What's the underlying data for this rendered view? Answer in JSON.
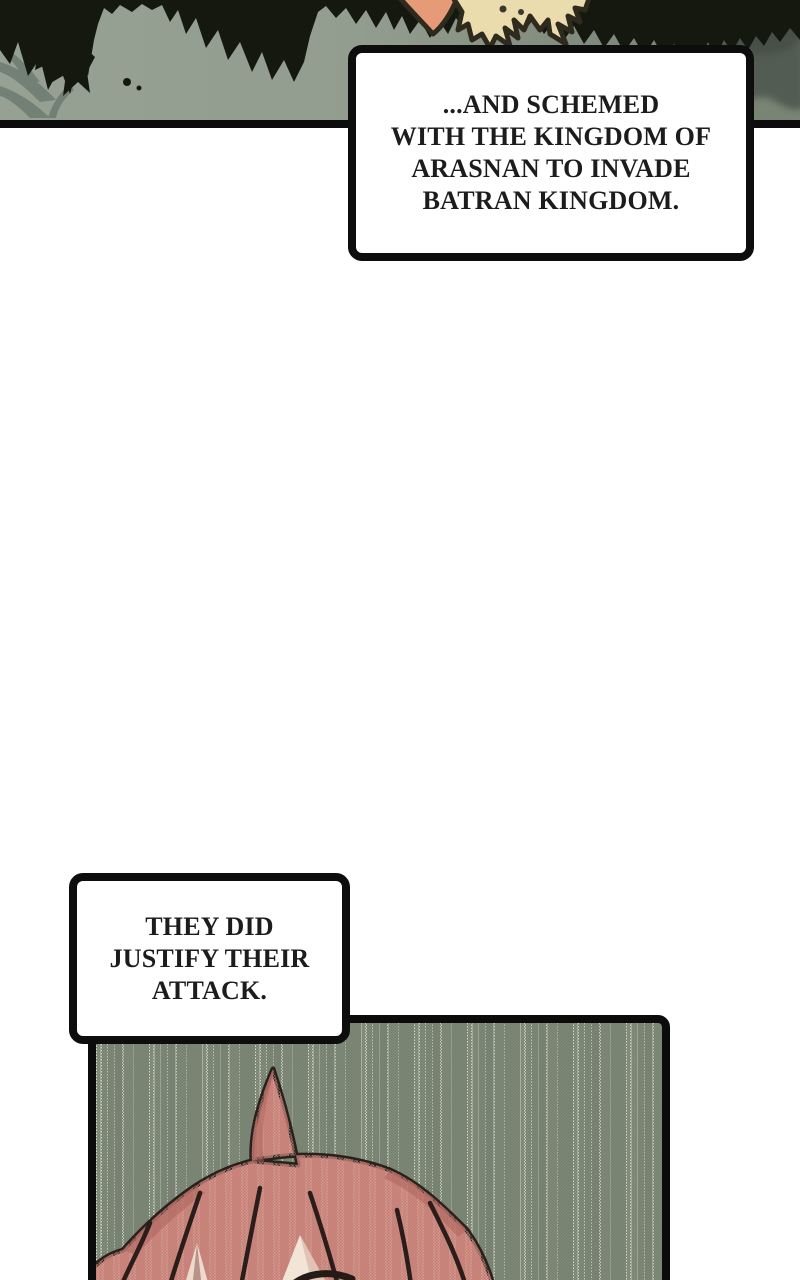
{
  "page": {
    "width": 800,
    "height": 1280,
    "background": "#ffffff",
    "kind": "webtoon-episode-segment"
  },
  "narration": {
    "box1": {
      "lines": [
        "...AND SCHEMED",
        "WITH THE KINGDOM OF",
        "ARASNAN TO INVADE",
        "BATRAN KINGDOM."
      ],
      "text_color": "#1c1c1c",
      "border_color": "#0d0d0d",
      "fill_color": "#ffffff"
    },
    "box2": {
      "lines": [
        "THEY DID",
        "JUSTIFY THEIR",
        "ATTACK."
      ],
      "text_color": "#1c1c1c",
      "border_color": "#0d0d0d",
      "fill_color": "#ffffff"
    }
  },
  "panels": {
    "forest": {
      "description": "forest canopy seen against sky with creature peeking at top",
      "background_left": "#97a193",
      "background_right": "#7a8476",
      "canopy_color": "#14180f",
      "frond_color": "#6b7870",
      "creature_orange": "#e59b77",
      "creature_cream": "#ebdcae",
      "bottom_border": "#0c0c0c"
    },
    "rain": {
      "description": "halftone rain-streak panel with top of pink-haired head",
      "base_color": "#75806f",
      "streak_light": "#e4eada",
      "hair_color": "#c47e76",
      "hair_light": "#e9bcae",
      "hair_shade": "#aa6159",
      "skin_color": "#f2e5d8",
      "line_color": "#2b1e1a",
      "border_color": "#0b0b0b"
    }
  }
}
